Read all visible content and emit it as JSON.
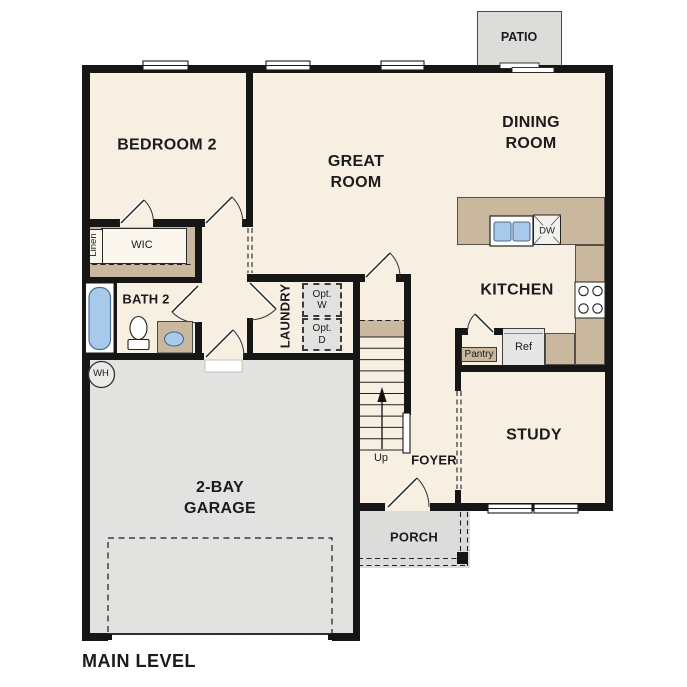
{
  "plan": {
    "title": "MAIN LEVEL",
    "rooms": {
      "bedroom2": "BEDROOM 2",
      "great_room": [
        "GREAT",
        "ROOM"
      ],
      "dining_room": [
        "DINING",
        "ROOM"
      ],
      "kitchen": "KITCHEN",
      "study": "STUDY",
      "foyer": "FOYER",
      "porch": "PORCH",
      "patio": "PATIO",
      "garage": [
        "2-BAY",
        "GARAGE"
      ],
      "bath2": "BATH 2",
      "laundry": "LAUNDRY",
      "wic": "WIC",
      "linen": "Linen"
    },
    "fixtures": {
      "water_heater": "WH",
      "dishwasher": "DW",
      "refrigerator": "Ref",
      "pantry": "Pantry",
      "opt_washer": [
        "Opt.",
        "W"
      ],
      "opt_dryer": [
        "Opt.",
        "D"
      ],
      "stairs_up": "Up"
    },
    "colors": {
      "floor": "#f7efe2",
      "counter_tan": "#c9b79e",
      "garage_gray": "#e2e2e0",
      "patio_gray": "#dcdcda",
      "appliance_gray": "#e6e6e4",
      "fixture_blue": "#a9c9ea",
      "wall_black": "#161616"
    }
  }
}
